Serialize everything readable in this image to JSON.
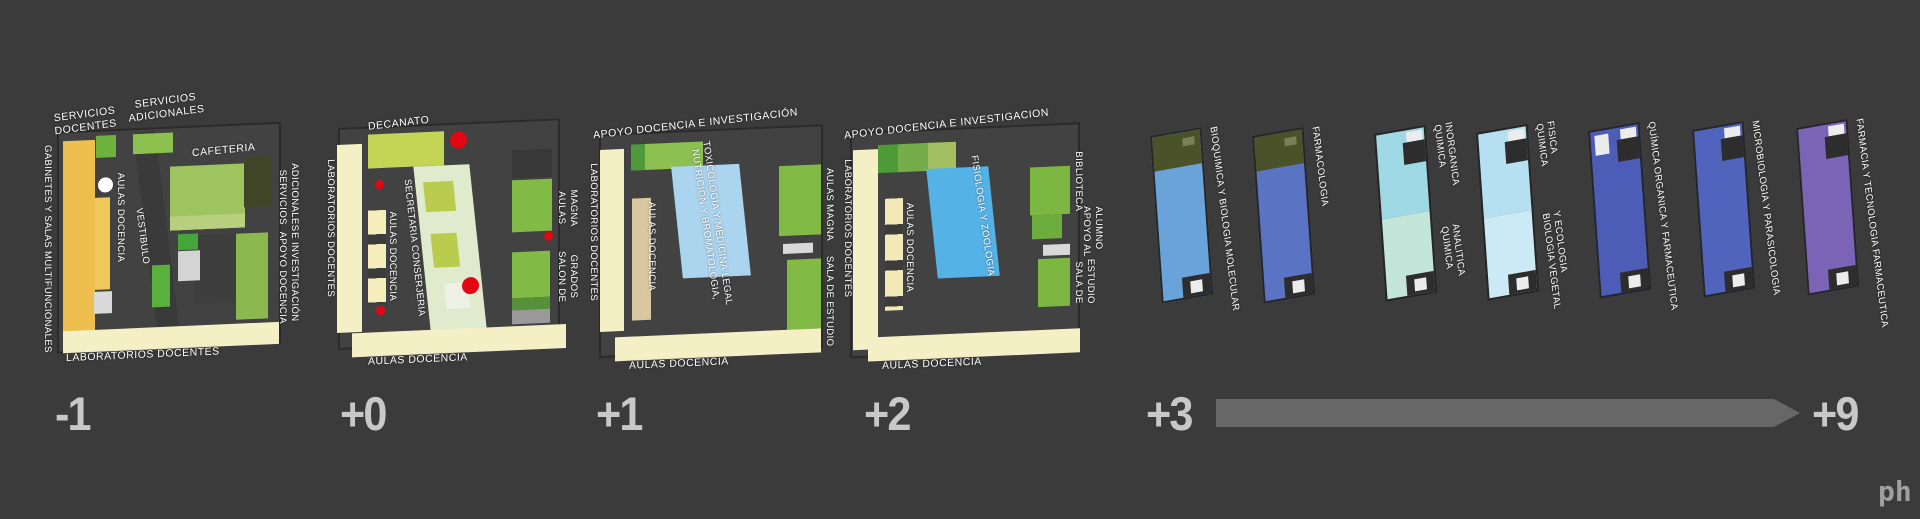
{
  "title": "Faculty building floor plans diagram",
  "colors": {
    "background": "#3b3b3b",
    "plan_body": "#424242",
    "pale_yellow": "#f5efc5",
    "orange": "#eebf4e",
    "green": "#86bb4a",
    "green_dark": "#4f9a38",
    "olive": "#4b5129",
    "decanato_green": "#c4d455",
    "secretaria_slab": "#e0eacd",
    "blue_light": "#abd4ee",
    "blue": "#55b2e7",
    "tan": "#d8c7a1",
    "red_marker": "#e30613",
    "number_gray": "#c8c8c8",
    "arrow_gray": "#676767"
  },
  "icons": {
    "red_dot": "red-dot-marker",
    "white_circle": "white-circle-marker",
    "arrow": "right-arrow"
  },
  "floors": [
    {
      "number": "-1",
      "labels": {
        "servicios_docentes": [
          "SERVICIOS",
          "DOCENTES"
        ],
        "servicios_adicionales_top": [
          "SERVICIOS",
          "ADICIONALES"
        ],
        "cafeteria": "CAFETERIA",
        "gabinetes": "GABINETES Y SALAS MULTIFUNCIONALES",
        "aulas_docencia": "AULAS DOCENCIA",
        "vestibulo": "VESTIBULO",
        "servicios_adicionales_right": [
          "SERVICIOS",
          "ADICIONALES"
        ],
        "apoyo": [
          "APOYO DOCENCIA",
          "E INVESTIGACIÓN"
        ],
        "laboratorios": "LABORATORIOS DOCENTES"
      }
    },
    {
      "number": "+0",
      "labels": {
        "decanato": "DECANATO",
        "laboratorios": "LABORATORIOS DOCENTES",
        "aulas_docencia_left": "AULAS DOCENCIA",
        "secretaria": "SECRETARIA CONSERJERIA",
        "aulas_magna": [
          "AULAS",
          "MAGNA"
        ],
        "salon_grados": [
          "SALON DE",
          "GRADOS"
        ],
        "aulas_docencia_bottom": "AULAS DOCENCIA"
      },
      "markers": {
        "count": 5,
        "color": "#e30613"
      }
    },
    {
      "number": "+1",
      "labels": {
        "apoyo": "APOYO DOCENCIA E INVESTIGACIÓN",
        "laboratorios": "LABORATORIOS DOCENTES",
        "aulas_docencia_left": "AULAS DOCENCIA",
        "departamentos": [
          "NUTRICION Y BROMATOLOGIA,",
          "TOXICOLOGIA Y MEDICINA LEGAL"
        ],
        "aulas_magna": "AULAS MAGNA",
        "sala_estudio": "SALA DE ESTUDIO",
        "aulas_docencia_bottom": "AULAS DOCENCIA"
      }
    },
    {
      "number": "+2",
      "labels": {
        "apoyo": "APOYO DOCENCIA E INVESTIGACION",
        "laboratorios": "LABORATORIOS DOCENTES",
        "aulas_docencia_left": "AULAS DOCENCIA",
        "departamentos": "FISIOLOGIA Y ZOOLOGIA",
        "biblioteca": "BIBLIOTECA",
        "apoyo_alumno": [
          "APOYO AL",
          "ALUMNO"
        ],
        "sala_estudio": [
          "SALA DE",
          "ESTUDIO"
        ],
        "aulas_docencia_bottom": "AULAS DOCENCIA"
      }
    }
  ],
  "towers": [
    {
      "label": "BIOQUIMICA Y BIOLOGIA MOLECULAR",
      "color": "#69a3d9",
      "top_color": "#4b5129"
    },
    {
      "label": "FARMACOLOGIA",
      "color": "#5b73c3",
      "top_color": "#4b5129"
    },
    {
      "label_top": [
        "QUIMICA",
        "INORGANICA"
      ],
      "label_bottom": [
        "QUIMICA",
        "ANALITICA"
      ],
      "color_top": "#a0d9e6",
      "color_bottom": "#c3e5da"
    },
    {
      "label_top": [
        "QUIMICA",
        "FISICA"
      ],
      "label_bottom": [
        "BIOLOGIA VEGETAL",
        "Y ECOLOGIA"
      ],
      "color_top": "#b6e0f1",
      "color_bottom": "#cbeaf5"
    },
    {
      "label": "QUÍMICA ORGANICA Y FARMACEUTICA",
      "color": "#4c5cb7"
    },
    {
      "label": "MICROBIOLOGIA Y PARASICOLOGIA",
      "color": "#5064be"
    },
    {
      "label": "FARMACIA Y TECNOLOGIA FARMACEUTICA",
      "color": "#7b63b5"
    }
  ],
  "footer": {
    "timeline_start": "+3",
    "timeline_end": "+9",
    "logo": "ph"
  }
}
